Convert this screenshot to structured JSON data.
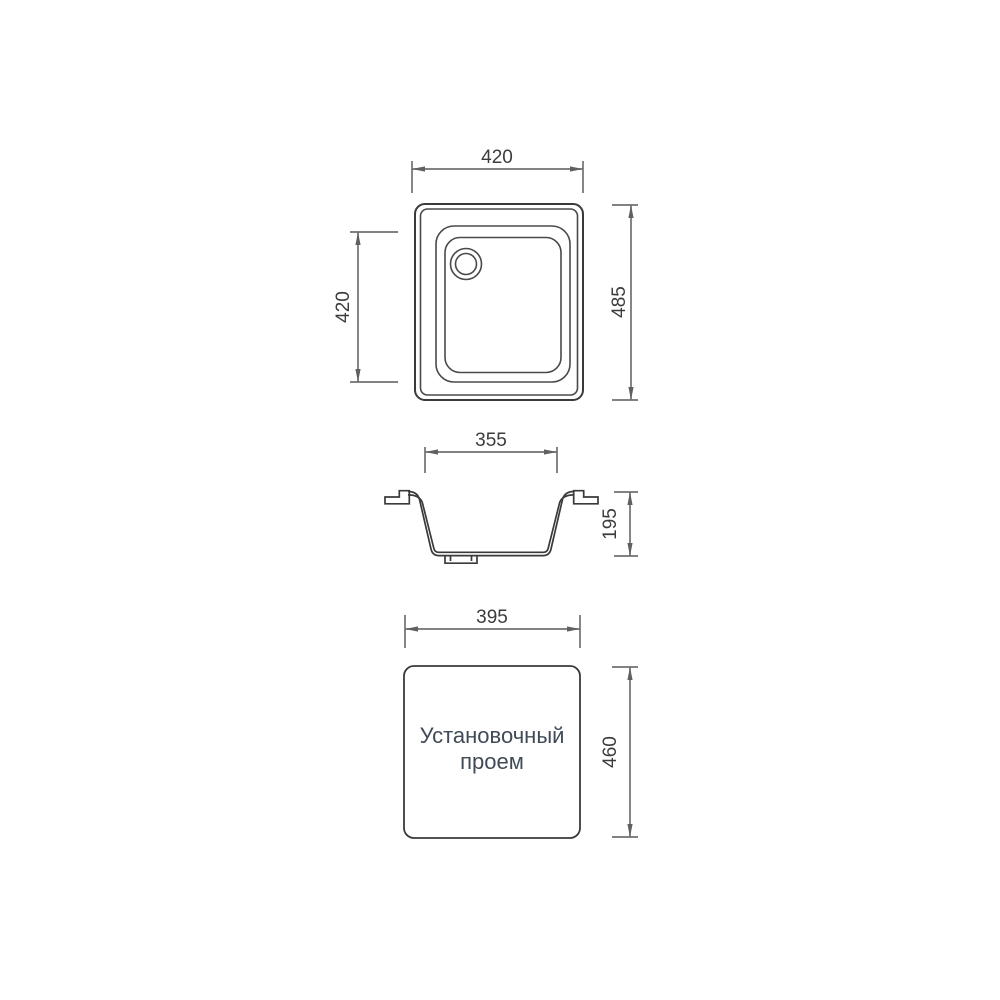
{
  "drawing": {
    "type": "sink-installation-dimension-drawing",
    "colors": {
      "background": "#ffffff",
      "object_line": "#3a3a3a",
      "dimension_line": "#707070",
      "dimension_text": "#3c3c3c",
      "label_text": "#414b57"
    },
    "top_view": {
      "width_label": "420",
      "bowl_height_label": "420",
      "height_label": "485"
    },
    "section_view": {
      "width_label": "355",
      "height_label": "195"
    },
    "cutout_view": {
      "width_label": "395",
      "height_label": "460",
      "label_line1": "Установочный",
      "label_line2": "проем"
    }
  }
}
